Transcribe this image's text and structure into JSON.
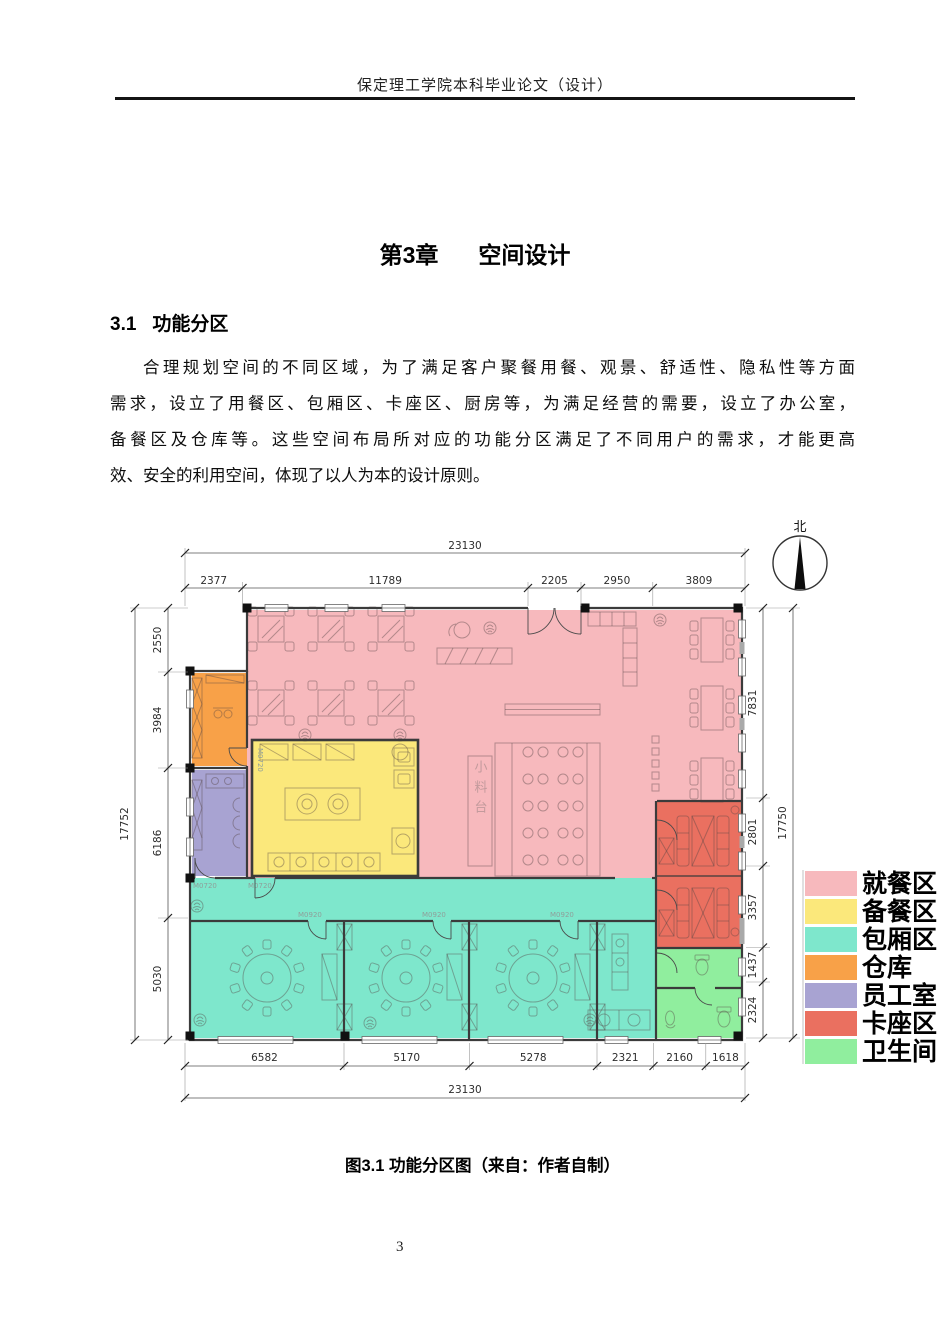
{
  "page": {
    "header": "保定理工学院本科毕业论文（设计）",
    "page_number": "3"
  },
  "chapter": {
    "number": "第3章",
    "title": "空间设计"
  },
  "section": {
    "number": "3.1",
    "title": "功能分区"
  },
  "paragraph": {
    "lines": [
      "合理规划空间的不同区域，为了满足客户聚餐用餐、观景、舒适性、隐私性等方面",
      "需求，设立了用餐区、包厢区、卡座区、厨房等，为满足经营的需要，设立了办公室，",
      "备餐区及仓库等。这些空间布局所对应的功能分区满足了不同用户的需求，才能更高",
      "效、安全的利用空间，体现了以人为本的设计原则。"
    ]
  },
  "figure": {
    "caption": "图3.1 功能分区图（来自：作者自制）",
    "north_label": "北",
    "plan_labels": {
      "condiment_station": "小料台",
      "door_m0920": "M0920",
      "door_m0720": "M0720"
    },
    "legend": {
      "items": [
        {
          "label": "就餐区",
          "color": "#F7B9BD"
        },
        {
          "label": "备餐区",
          "color": "#FBE87B"
        },
        {
          "label": "包厢区",
          "color": "#7EE7CC"
        },
        {
          "label": "仓库",
          "color": "#F8A148"
        },
        {
          "label": "员工室",
          "color": "#A8A3D2"
        },
        {
          "label": "卡座区",
          "color": "#EA7060"
        },
        {
          "label": "卫生间",
          "color": "#90EE9E"
        }
      ]
    },
    "dimensions": {
      "top": {
        "total": "23130",
        "segments": [
          "2377",
          "11789",
          "2205",
          "2950",
          "3809"
        ]
      },
      "bottom": {
        "total": "23130",
        "segments": [
          "6582",
          "5170",
          "5278",
          "2321",
          "2160",
          "1618"
        ]
      },
      "left": {
        "total": "17752",
        "segments": [
          "2550",
          "3984",
          "6186",
          "5030"
        ]
      },
      "right": {
        "total": "17750",
        "segments": [
          "7831",
          "2801",
          "3357",
          "1437",
          "2324"
        ]
      }
    }
  }
}
